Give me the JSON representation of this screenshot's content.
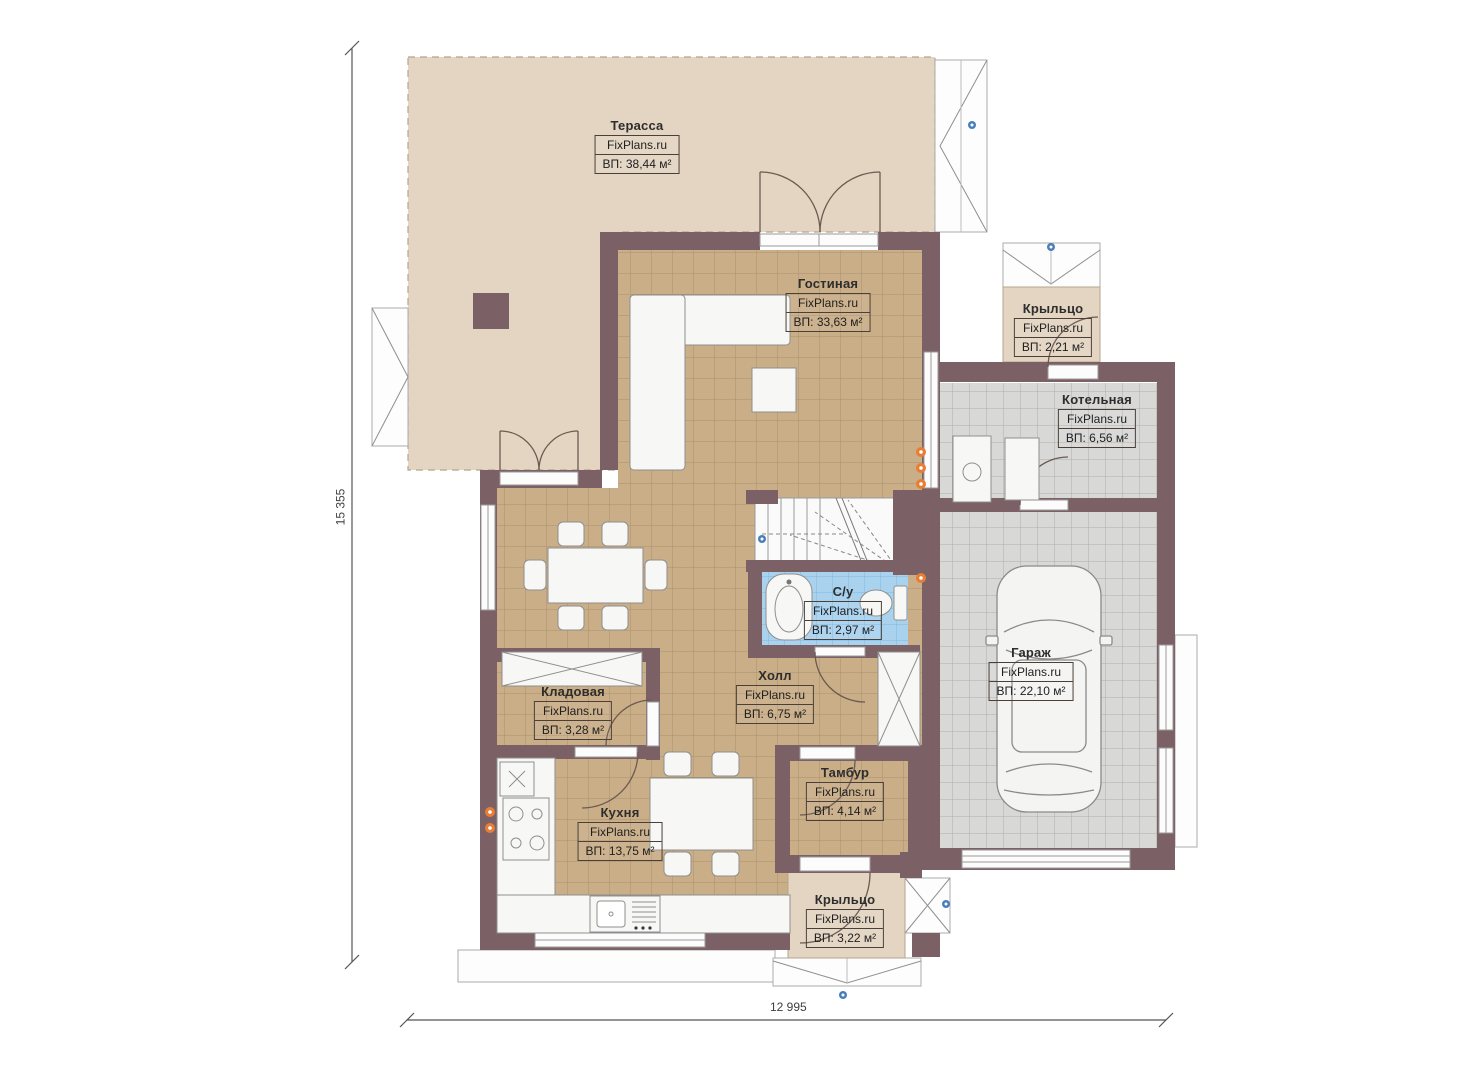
{
  "plan": {
    "watermark": "FixPlans.ru",
    "dimensions": {
      "height": "15 355",
      "width": "12 995"
    },
    "rooms": [
      {
        "id": "terrace",
        "name": "Терасса",
        "area": "ВП: 38,44 м²"
      },
      {
        "id": "living",
        "name": "Гостиная",
        "area": "ВП: 33,63 м²"
      },
      {
        "id": "porch-top",
        "name": "Крыльцо",
        "area": "ВП: 2,21 м²"
      },
      {
        "id": "boiler",
        "name": "Котельная",
        "area": "ВП: 6,56 м²"
      },
      {
        "id": "bathroom",
        "name": "С/у",
        "area": "ВП: 2,97 м²"
      },
      {
        "id": "garage",
        "name": "Гараж",
        "area": "ВП: 22,10 м²"
      },
      {
        "id": "storage",
        "name": "Кладовая",
        "area": "ВП: 3,28 м²"
      },
      {
        "id": "hall",
        "name": "Холл",
        "area": "ВП: 6,75 м²"
      },
      {
        "id": "tambur",
        "name": "Тамбур",
        "area": "ВП: 4,14 м²"
      },
      {
        "id": "kitchen",
        "name": "Кухня",
        "area": "ВП: 13,75 м²"
      },
      {
        "id": "porch-bottom",
        "name": "Крыльцо",
        "area": "ВП: 3,22 м²"
      }
    ],
    "colors": {
      "wall": "#7b6165",
      "floor_wood": "#c9ae87",
      "floor_gray": "#d8d8d6",
      "floor_bath": "#a9d2ee",
      "terrace": "#e4d5c2",
      "accent_orange": "#e87e35",
      "accent_blue": "#4a7ebb"
    }
  }
}
